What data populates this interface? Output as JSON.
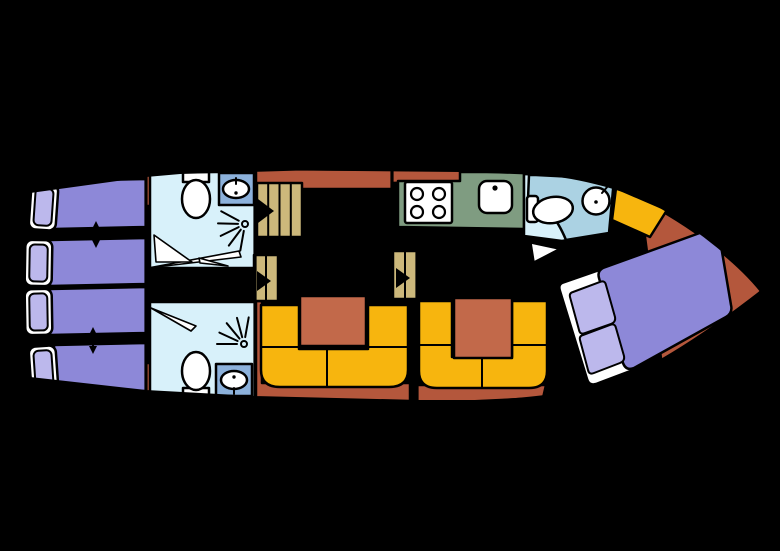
{
  "plan": {
    "kind": "boat-deck-floor-plan",
    "aft_cabin": {
      "single_beds": 4,
      "convertible_bed_pairs": 2,
      "join_arrows": 2
    },
    "aft_bathrooms": {
      "count": 2,
      "fixtures": [
        "toilet",
        "washbasin",
        "shower"
      ]
    },
    "companionway": {
      "main_stairs_steps": 4,
      "small_steps_sets": 2
    },
    "salon": {
      "u_shaped_benches": 2,
      "tables": 2
    },
    "galley": {
      "stove_burners": 4,
      "sinks": 1
    },
    "bow_bathroom": {
      "fixtures": [
        "toilet",
        "washbasin"
      ]
    },
    "bow_cabin": {
      "double_beds": 1,
      "pillows": 2,
      "side_bench": 1
    }
  },
  "colors": {
    "background": "#000000",
    "outline": "#000000",
    "floor": "#ece3d1",
    "deck": "#b4573c",
    "table": "#c2694a",
    "bench": "#f7b50e",
    "stairs": "#ccb87b",
    "bed": "#8d88d8",
    "pillow": "#bcb8ec",
    "fixture": "#ffffff",
    "bathroom": "#d8f1fa",
    "sink_counter": "#8cb1db",
    "bow_counter": "#abd2e3",
    "galley_counter": "#7f9c81"
  }
}
